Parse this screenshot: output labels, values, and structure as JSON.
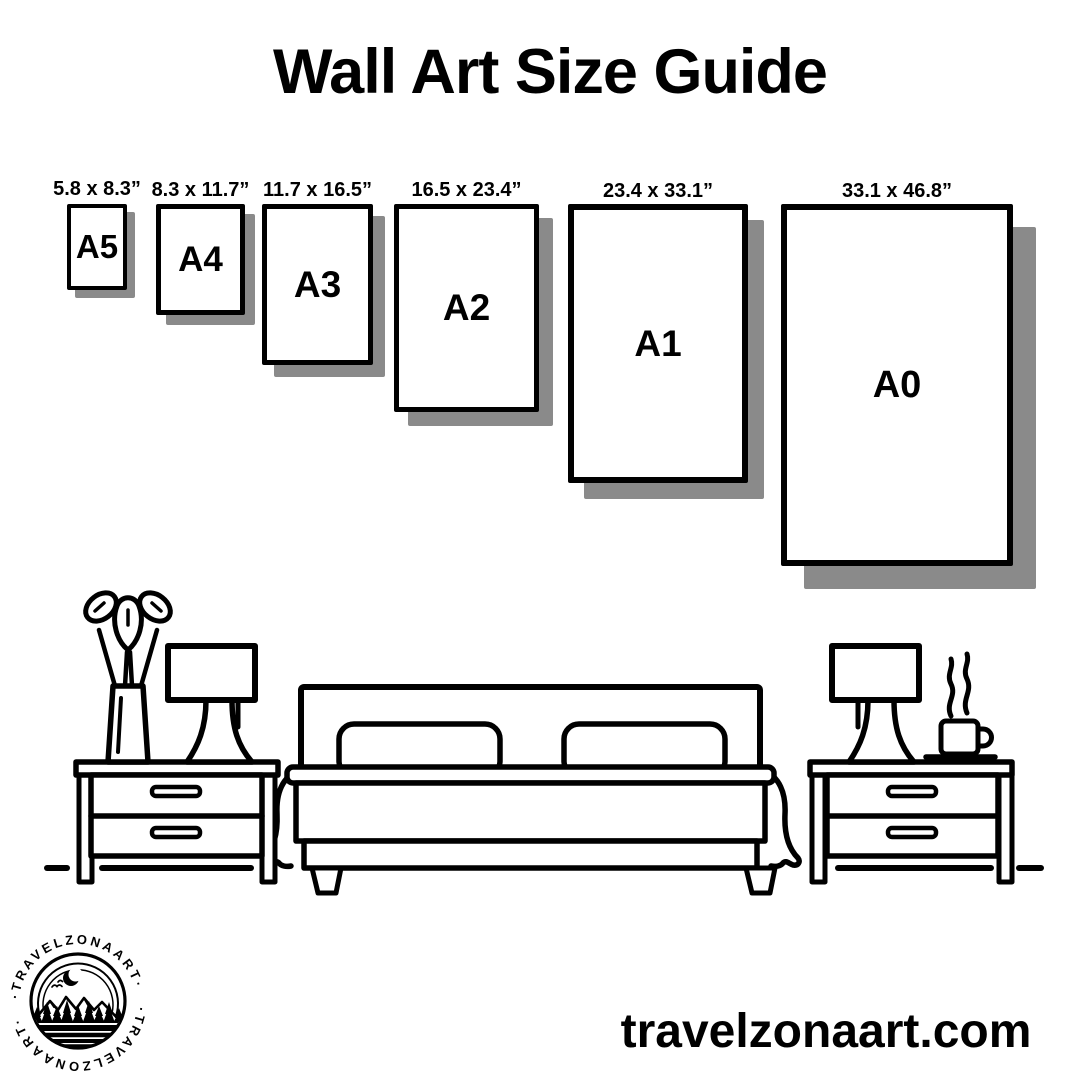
{
  "title": "Wall Art Size Guide",
  "footer": {
    "website": "travelzonaart.com"
  },
  "logo": {
    "brand": "TRAVELZONAART",
    "ring_text": "·TRAVELZONAART·"
  },
  "colors": {
    "ink": "#000000",
    "shadow": "#8a8a8a",
    "background": "#ffffff"
  },
  "sizes": [
    {
      "label": "A5",
      "dimensions": "5.8 x 8.3”",
      "x": 67,
      "y": 204,
      "w": 60,
      "h": 86,
      "border": 4,
      "shadow": 8,
      "letter_px": 33
    },
    {
      "label": "A4",
      "dimensions": "8.3 x 11.7”",
      "x": 156,
      "y": 204,
      "w": 89,
      "h": 111,
      "border": 5,
      "shadow": 10,
      "letter_px": 35
    },
    {
      "label": "A3",
      "dimensions": "11.7 x 16.5”",
      "x": 262,
      "y": 204,
      "w": 111,
      "h": 161,
      "border": 5,
      "shadow": 12,
      "letter_px": 37
    },
    {
      "label": "A2",
      "dimensions": "16.5 x 23.4”",
      "x": 394,
      "y": 204,
      "w": 145,
      "h": 208,
      "border": 5,
      "shadow": 14,
      "letter_px": 37
    },
    {
      "label": "A1",
      "dimensions": "23.4 x 33.1”",
      "x": 568,
      "y": 204,
      "w": 180,
      "h": 279,
      "border": 6,
      "shadow": 16,
      "letter_px": 37
    },
    {
      "label": "A0",
      "dimensions": "33.1 x 46.8”",
      "x": 781,
      "y": 204,
      "w": 232,
      "h": 362,
      "border": 6,
      "shadow": 23,
      "letter_px": 38
    }
  ]
}
